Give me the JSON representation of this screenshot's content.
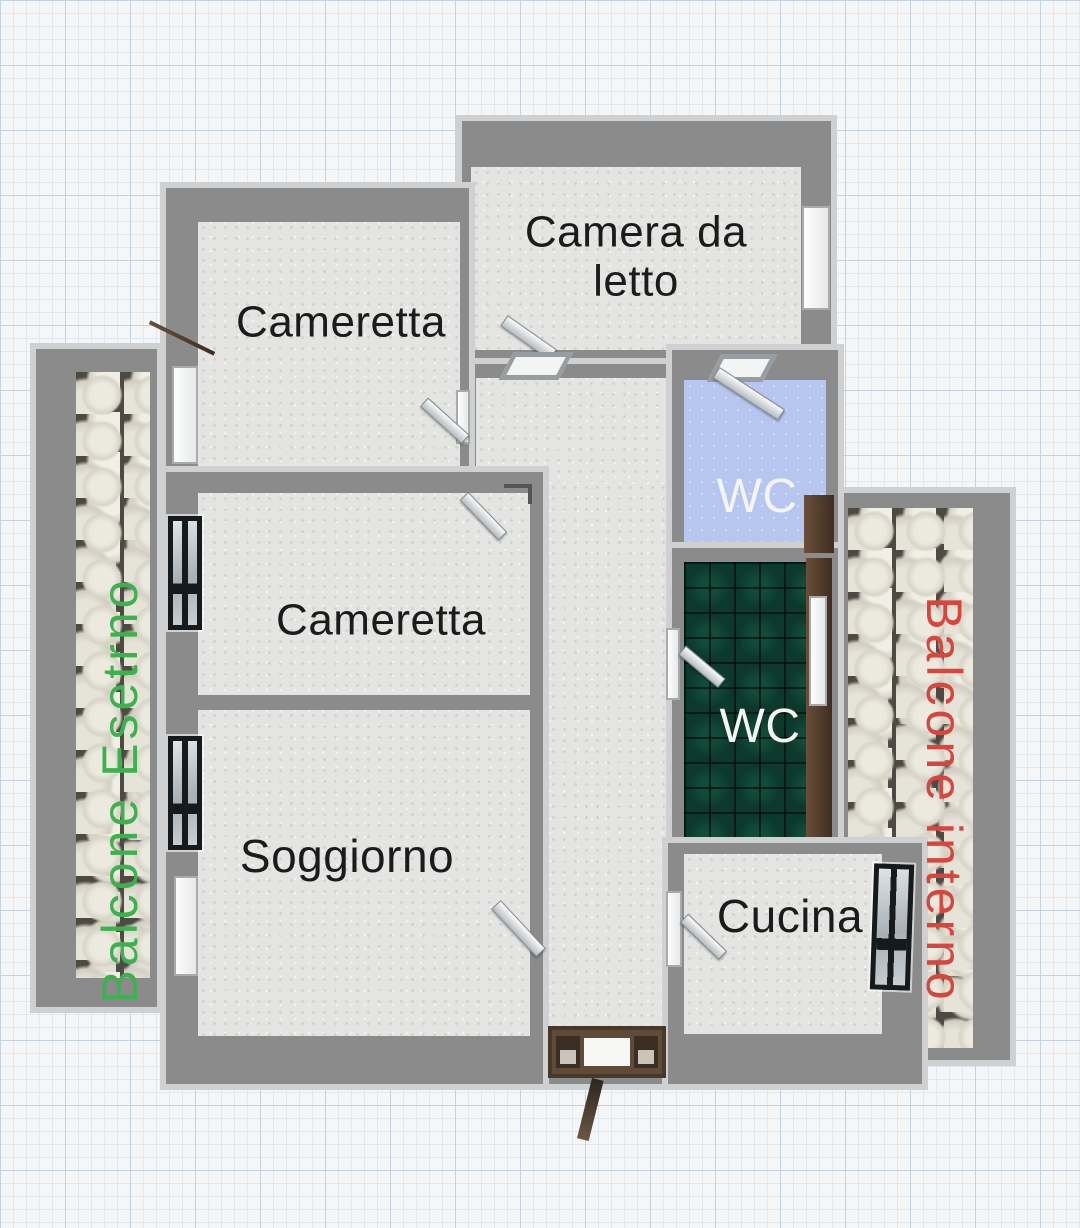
{
  "plan": {
    "type": "apartment-floor-plan",
    "rooms": {
      "cameretta_top": {
        "label": "Cameretta"
      },
      "camera_da_letto": {
        "label": "Camera da letto"
      },
      "cameretta_mid": {
        "label": "Cameretta"
      },
      "soggiorno": {
        "label": "Soggiorno"
      },
      "wc_blue": {
        "label": "WC"
      },
      "wc_green": {
        "label": "WC"
      },
      "cucina": {
        "label": "Cucina"
      }
    },
    "balconies": {
      "esterno": {
        "label": "Balcone Esetrno",
        "text_color": "#3cb24e"
      },
      "interno": {
        "label": "Balcone interno",
        "text_color": "#d7453d"
      }
    },
    "colors": {
      "wall": "#8b8b8b",
      "wall_outline": "#cfd0d2",
      "floor": "#e4e4e2",
      "wc_blue_floor": "#b7c6ef",
      "wc_green_tile": "#0c392c",
      "stone_crevice": "#4e4a43",
      "paper_grid_major": "#c6d1de",
      "paper_grid_minor": "#e2e8ef",
      "room_text": "#1b1b1b",
      "wc_text": "#f4f4f4",
      "door_wood": "#5a4332"
    }
  }
}
